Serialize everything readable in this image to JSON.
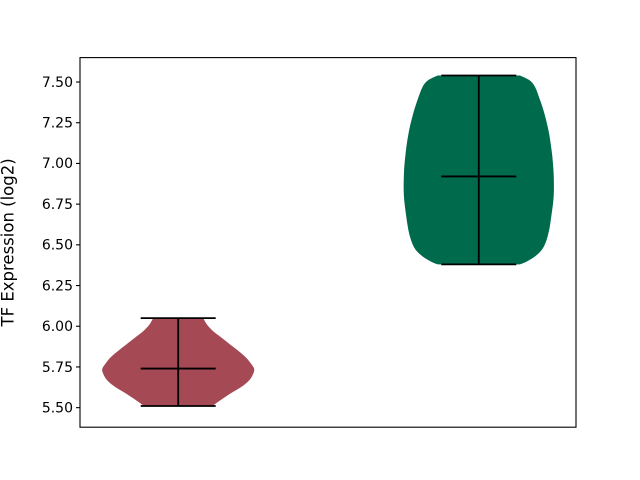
{
  "figure": {
    "background": "#ffffff",
    "border_color": "#000000"
  },
  "chart_data": {
    "type": "violin",
    "title": "",
    "xlabel": "",
    "ylabel": "TF Expression (log2)",
    "grid": false,
    "legend": null,
    "ylim": [
      5.38,
      7.65
    ],
    "ytick_labels": [
      "5.50",
      "5.75",
      "6.00",
      "6.25",
      "6.50",
      "6.75",
      "7.00",
      "7.25",
      "7.50"
    ],
    "ytick_values": [
      5.5,
      5.75,
      6.0,
      6.25,
      6.5,
      6.75,
      7.0,
      7.25,
      7.5
    ],
    "xtick_labels": [],
    "line_color": "#000000",
    "groups": [
      {
        "name": "group-1",
        "color": "#a54a55",
        "min": 5.51,
        "max": 6.05,
        "median": 5.74,
        "x_frac": 0.198,
        "max_halfwidth_frac": 0.153,
        "bar_halfwidth_frac": 0.0756,
        "shape": [
          [
            6.05,
            0.33
          ],
          [
            6.01,
            0.38
          ],
          [
            5.97,
            0.46
          ],
          [
            5.93,
            0.57
          ],
          [
            5.89,
            0.68
          ],
          [
            5.85,
            0.79
          ],
          [
            5.81,
            0.89
          ],
          [
            5.77,
            0.96
          ],
          [
            5.74,
            1.0
          ],
          [
            5.71,
            0.99
          ],
          [
            5.67,
            0.94
          ],
          [
            5.63,
            0.84
          ],
          [
            5.59,
            0.7
          ],
          [
            5.55,
            0.57
          ],
          [
            5.52,
            0.48
          ],
          [
            5.51,
            0.46
          ]
        ]
      },
      {
        "name": "group-2",
        "color": "#006a4c",
        "min": 6.38,
        "max": 7.54,
        "median": 6.92,
        "x_frac": 0.804,
        "max_halfwidth_frac": 0.151,
        "bar_halfwidth_frac": 0.0756,
        "shape": [
          [
            7.54,
            0.55
          ],
          [
            7.51,
            0.68
          ],
          [
            7.47,
            0.75
          ],
          [
            7.4,
            0.81
          ],
          [
            7.3,
            0.88
          ],
          [
            7.18,
            0.94
          ],
          [
            7.05,
            0.98
          ],
          [
            6.93,
            1.0
          ],
          [
            6.8,
            1.0
          ],
          [
            6.68,
            0.97
          ],
          [
            6.57,
            0.93
          ],
          [
            6.49,
            0.87
          ],
          [
            6.44,
            0.78
          ],
          [
            6.4,
            0.65
          ],
          [
            6.38,
            0.55
          ]
        ]
      }
    ]
  }
}
